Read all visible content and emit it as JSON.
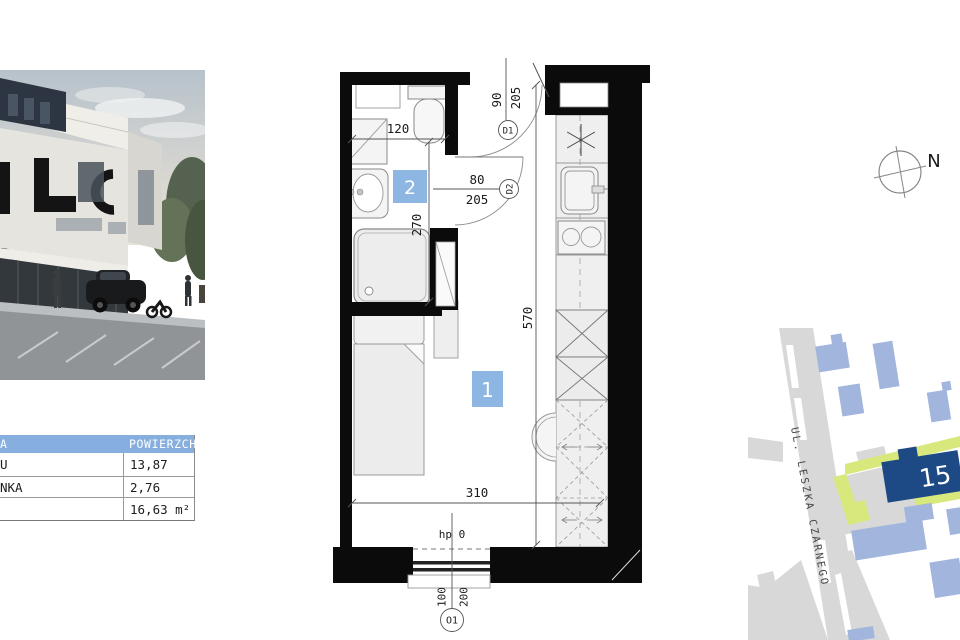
{
  "table": {
    "header": {
      "name_fragment": "A",
      "area_label": "POWIERZCHNIA"
    },
    "rows": [
      {
        "name_fragment": "U",
        "value": "13,87"
      },
      {
        "name_fragment": "NKA",
        "value": "2,76"
      },
      {
        "name_fragment": "",
        "value": "16,63 m²"
      }
    ]
  },
  "floorplan": {
    "room_labels": {
      "main": "1",
      "bath": "2"
    },
    "dims": {
      "bath_width": "120",
      "bath_depth": "270",
      "door2_width": "80",
      "door2_height": "205",
      "door1_width": "90",
      "door1_height": "205",
      "room_length": "570",
      "room_width": "310",
      "sill_note": "hp 0",
      "window_dim_a": "100",
      "window_dim_b": "200"
    },
    "markers": {
      "door1": "D1",
      "door2": "D2",
      "window1": "O1"
    }
  },
  "map": {
    "street_label": "UL. LESZKA CZARNEGO",
    "highlight_building": "15"
  },
  "compass": {
    "north_label": "N"
  },
  "colors": {
    "room_label_bg": "#8db6e2",
    "table_header_bg": "#86aede",
    "map_highlight_building": "#1d4a84",
    "map_building": "#a2b5dc",
    "map_green": "#d9e87d",
    "map_road": "#d8d8d8"
  }
}
